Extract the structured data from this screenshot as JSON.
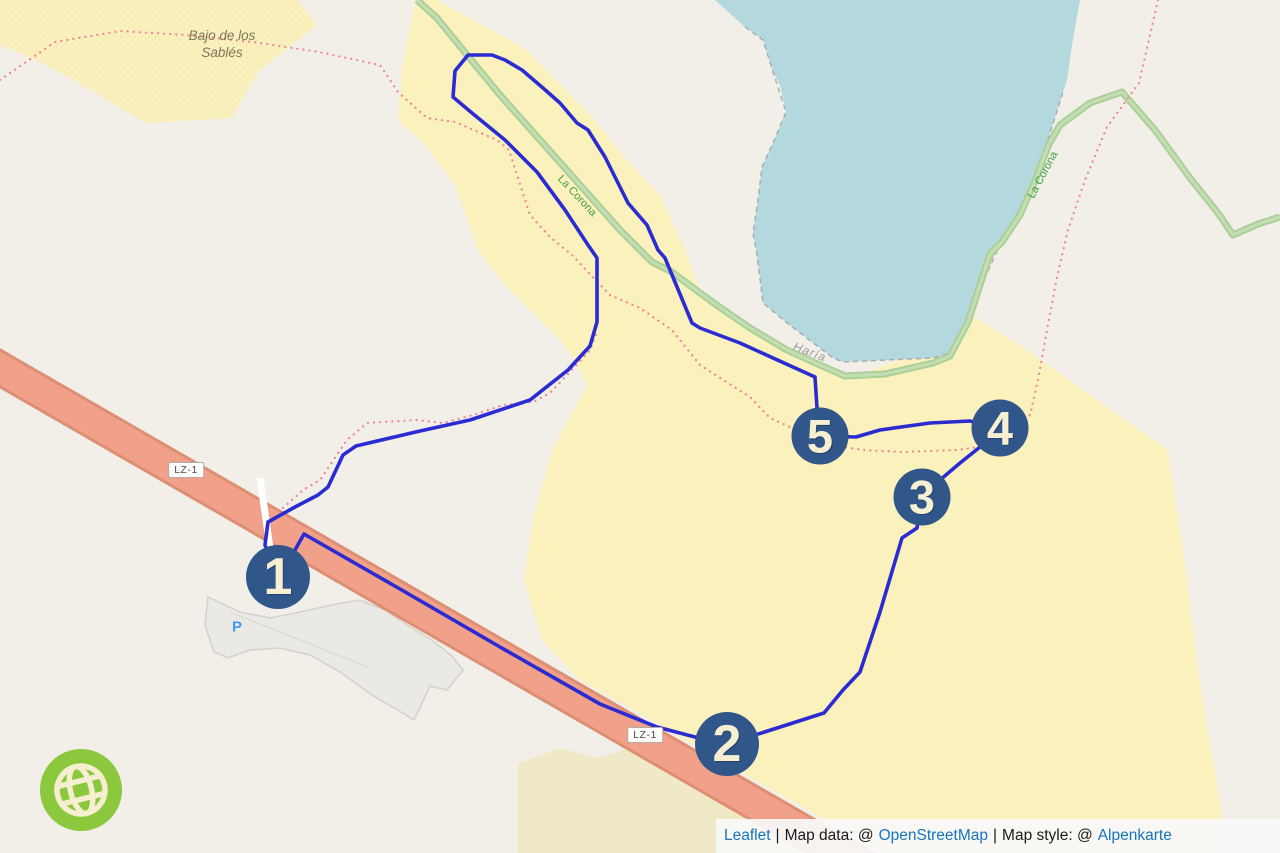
{
  "map": {
    "place_labels": {
      "sand_area": "Bajo de los Sablés",
      "path_name_1": "La Corona",
      "path_name_2": "La Corona",
      "town": "Haría",
      "parking": "P"
    },
    "road_refs": {
      "badge_1": "LZ-1",
      "badge_2": "LZ-1"
    },
    "route_markers": [
      {
        "label": "1",
        "x": 278,
        "y": 577
      },
      {
        "label": "2",
        "x": 727,
        "y": 744
      },
      {
        "label": "3",
        "x": 922,
        "y": 497
      },
      {
        "label": "4",
        "x": 1000,
        "y": 428
      },
      {
        "label": "5",
        "x": 820,
        "y": 436
      }
    ],
    "route": {
      "color": "#2b2bd2",
      "points": [
        [
          278,
          577
        ],
        [
          295,
          550
        ],
        [
          304,
          534
        ],
        [
          400,
          589
        ],
        [
          500,
          647
        ],
        [
          600,
          704
        ],
        [
          657,
          727
        ],
        [
          695,
          737
        ],
        [
          727,
          744
        ],
        [
          824,
          713
        ],
        [
          843,
          690
        ],
        [
          860,
          672
        ],
        [
          880,
          612
        ],
        [
          902,
          538
        ],
        [
          917,
          528
        ],
        [
          922,
          497
        ],
        [
          940,
          480
        ],
        [
          960,
          463
        ],
        [
          985,
          443
        ],
        [
          1000,
          428
        ],
        [
          970,
          421
        ],
        [
          930,
          423
        ],
        [
          880,
          430
        ],
        [
          856,
          437
        ],
        [
          820,
          436
        ],
        [
          817,
          408
        ],
        [
          815,
          377
        ],
        [
          740,
          343
        ],
        [
          700,
          328
        ],
        [
          692,
          323
        ],
        [
          665,
          258
        ],
        [
          658,
          250
        ],
        [
          647,
          225
        ],
        [
          628,
          203
        ],
        [
          605,
          157
        ],
        [
          588,
          130
        ],
        [
          577,
          123
        ],
        [
          560,
          103
        ],
        [
          543,
          88
        ],
        [
          522,
          70
        ],
        [
          505,
          60
        ],
        [
          492,
          55
        ],
        [
          468,
          55
        ],
        [
          455,
          71
        ],
        [
          453,
          97
        ],
        [
          472,
          113
        ],
        [
          505,
          140
        ],
        [
          537,
          172
        ],
        [
          565,
          210
        ],
        [
          588,
          245
        ],
        [
          597,
          258
        ],
        [
          597,
          322
        ],
        [
          590,
          346
        ],
        [
          568,
          370
        ],
        [
          530,
          400
        ],
        [
          470,
          420
        ],
        [
          420,
          431
        ],
        [
          356,
          446
        ],
        [
          343,
          455
        ],
        [
          328,
          487
        ],
        [
          318,
          495
        ],
        [
          295,
          507
        ],
        [
          268,
          522
        ],
        [
          265,
          545
        ],
        [
          278,
          577
        ]
      ]
    },
    "colors": {
      "land": "#f2efe9",
      "sand": "#fbf1bd",
      "sand_muted": "#f0e9c8",
      "water": "#b3d8de",
      "road_fill": "#f1a189",
      "road_casing": "#dd8f74",
      "footpath_green": "#a9cf97",
      "trail_dotted": "#ee8493",
      "marker_fill": "#30568a",
      "marker_text": "#f6efd2",
      "logo_green": "#8bc83e"
    }
  },
  "attribution": {
    "leaflet": "Leaflet",
    "sep1": "|",
    "map_data_prefix": "Map data: @",
    "osm": "OpenStreetMap",
    "sep2": "|",
    "map_style_prefix": "Map style: @",
    "style_name": "Alpenkarte"
  }
}
